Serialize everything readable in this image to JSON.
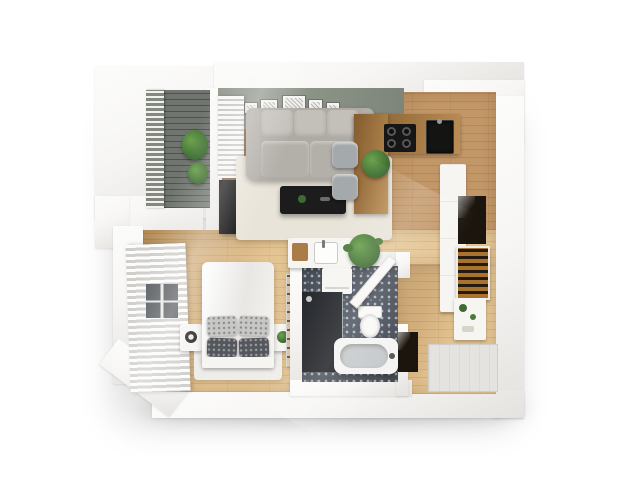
{
  "canvas": {
    "width": 640,
    "height": 480
  },
  "scene": {
    "description": "3D top-down architectural render of a one-bedroom apartment floor plan on a white background",
    "palette": {
      "wall": "#f7f6f4",
      "wall_shade": "#e4e2df",
      "wood": "#d9b57f",
      "wood_deep": "#b08050",
      "counter_wood": "#a97a42",
      "accent_green": "#8a9185",
      "balcony_deck": "#70756f",
      "sofa": "#b3afa9",
      "cushion": "#c3bfb9",
      "rug": "#e9e4d9",
      "black": "#1b1c1b",
      "tile_base": "#474e5a",
      "tile_dot": "#aeb5bf",
      "shower_dark": "#23262b",
      "plant": "#3c6b31",
      "pillow_light": "#c7c7c5",
      "pillow_dark": "#54575c",
      "white_furniture": "#f6f5f2",
      "mat": "#e4e3e0",
      "niche_dark": "#1b150d",
      "shadow": "rgba(0,0,0,0.16)"
    },
    "rooms": [
      {
        "id": "balcony",
        "name": "Balcony",
        "features": [
          "slatted railing",
          "dark decking",
          "potted plants"
        ]
      },
      {
        "id": "living-room",
        "name": "Living room",
        "features": [
          "sage green accent wall",
          "five picture frames",
          "window blinds",
          "wall-mounted TV",
          "grey three-seat sofa",
          "cream area rug",
          "black coffee table"
        ]
      },
      {
        "id": "kitchen",
        "name": "Kitchen",
        "features": [
          "L-shaped wooden counter",
          "four-burner cooktop",
          "black sink",
          "wooden peninsula bar",
          "two grey chairs",
          "potted plant"
        ]
      },
      {
        "id": "hallway",
        "name": "Hallway / entry",
        "features": [
          "dark entry niche",
          "slatted shoe rack",
          "tall storage cabinet",
          "console shelf with plants",
          "doormat"
        ]
      },
      {
        "id": "bedroom",
        "name": "Bedroom",
        "features": [
          "double bed with white duvet",
          "two light patterned pillows",
          "two dark patterned pillows",
          "two white nightstands",
          "bedside lamp",
          "bedside plant",
          "white rug",
          "slatted window shutters",
          "dark window",
          "bookshelf divider"
        ]
      },
      {
        "id": "bathroom",
        "name": "Bathroom",
        "features": [
          "dark mosaic tile floor",
          "vanity with basin and faucet",
          "wooden tray",
          "washing machine",
          "dark walk-in shower",
          "toilet",
          "bathtub",
          "open white door",
          "dark storage niche",
          "potted plant"
        ]
      }
    ]
  }
}
